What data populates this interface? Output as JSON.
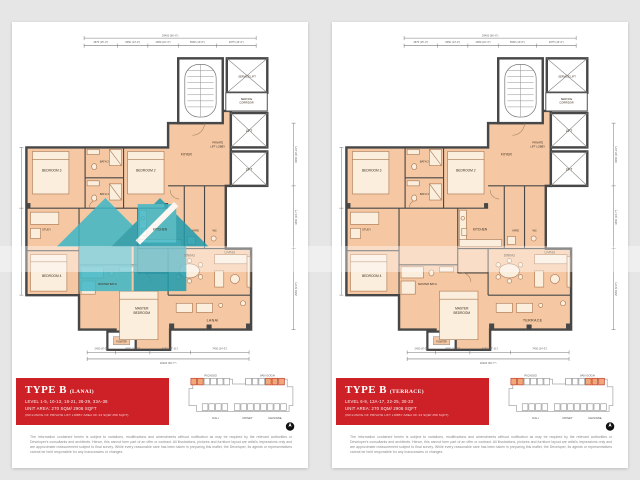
{
  "colors": {
    "page_background": "#e6e6e6",
    "floor_fill": "#f5c8a3",
    "wall": "#474747",
    "banner_red": "#ce2127",
    "watermark_teal": "#3db7c7",
    "keyplan_highlight": "#f0a878"
  },
  "shared": {
    "plan": {
      "rooms": {
        "master_bedroom_1": "MASTER",
        "master_bedroom_2": "BEDROOM",
        "bedroom2": "BEDROOM 2",
        "bedroom3": "BEDROOM 3",
        "bedroom4": "BEDROOM 4",
        "study": "STUDY",
        "bath2": "BATH 2",
        "bath3": "BATH 3",
        "master_bath": "MASTER BATH",
        "wc": "WC",
        "yard": "YARD",
        "kitchen": "KITCHEN",
        "foyer": "FOYER",
        "lobby_1": "PRIVATE",
        "lobby_2": "LIFT LOBBY",
        "lift": "LIFT",
        "service_lift": "SERVICE LIFT",
        "corridor_1": "SERVICE",
        "corridor_2": "CORRIDOR",
        "dining": "DINING",
        "living": "LIVING",
        "planter": "PLANTER"
      },
      "dims": {
        "top_total": "29400 (96'-6\")",
        "top_segments": [
          "4875 (16'-0\")",
          "3950 (13'-0\")",
          "4950 (16'-3\")",
          "5950 (19'-6\")",
          "4875 (16'-0\")"
        ],
        "bottom_total": "20300 (66'-7\")",
        "bottom_segments": [
          "2450 (8'-0\")",
          "4950 (16'-3\")",
          "5450 (17'-11\")",
          "7450 (24'-5\")"
        ],
        "right_segments": [
          "6050 (19'-10\")",
          "4450 (14'-7\")",
          "2950 (9'-8\")"
        ],
        "left_segment": "9450 (31'-0\")"
      }
    },
    "keyplan": {
      "towers": {
        "picasso": "PICASSO",
        "van_gogh": "VAN GOGH",
        "dali": "DALI",
        "monet": "MONET",
        "cezanne": "CEZANNE"
      },
      "compass_n": "N"
    },
    "disclaimer": "The information contained herein is subject to variations, modifications and amendments without notification as may be required by the relevant authorities or Developer's consultants and architects. Hence, this cannot form part of an offer or contract. All illustrations, pictures and furniture layout are artist's impressions only and are approximate measurement subject to final survey. While every reasonable care has been taken in preparing this leaflet, the Developer, its agents or representatives cannot be held responsible for any inaccuracies or changes."
  },
  "page1": {
    "banner": {
      "title": "TYPE B",
      "variant": "(LANAI)",
      "levels": "LEVEL 1-5, 10-13, 18-21, 26-29, 33A-38",
      "area": "UNIT AREA: 270 SQM/ 2906 SQFT",
      "note": "(INCLUSIVE OF PRIVATE LIFT LOBBY AREA OF 24 SQM/ 258 SQFT)"
    },
    "outdoor_label": "LANAI"
  },
  "page2": {
    "banner": {
      "title": "TYPE B",
      "variant": "(TERRACE)",
      "levels": "LEVEL 6-9, 13A-17, 22-25, 30-33",
      "area": "UNIT AREA: 270 SQM/ 2906 SQFT",
      "note": "(INCLUSIVE OF PRIVATE LIFT LOBBY AREA OF 24 SQM/ 258 SQFT)"
    },
    "outdoor_label": "TERRACE"
  }
}
